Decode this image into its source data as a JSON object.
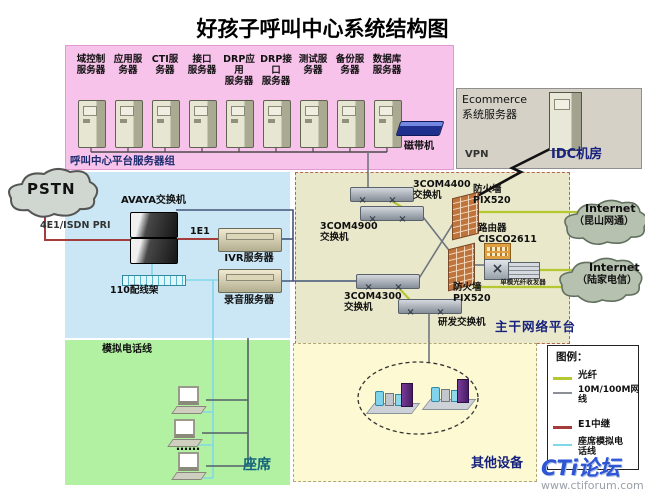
{
  "title": "好孩子呼叫中心系统结构图",
  "server_group": {
    "label": "呼叫中心平台服务器组",
    "servers": [
      "域控制\n服务器",
      "应用服\n务器",
      "CTI服\n务器",
      "接口\n服务器",
      "DRP应用\n服务器",
      "DRP接口\n服务器",
      "测试服\n务器",
      "备份服\n务器",
      "数据库\n服务器"
    ],
    "tape_drive": "磁带机"
  },
  "idc": {
    "label": "IDC机房",
    "vpn": "VPN",
    "server": "Ecommerce\n系统服务器"
  },
  "pstn": {
    "label": "PSTN",
    "trunk": "4E1/ISDN PRI"
  },
  "call_center": {
    "avaya": "AVAYA交换机",
    "e1": "1E1",
    "ivr": "IVR服务器",
    "recorder": "录音服务器",
    "patch_panel": "110配线架"
  },
  "agents": {
    "label": "座席",
    "analog_line": "模拟电话线",
    "dots": "……"
  },
  "backbone": {
    "label": "主干网络平台",
    "sw4400": "3COM4400\n交换机",
    "sw4900": "3COM4900\n交换机",
    "sw4300": "3COM4300\n交换机",
    "rd_switch": "研发交换机",
    "firewall_top": "防火墙\nPIX520",
    "firewall_bottom": "防火墙\nPIX520",
    "router": "路由器\nCISCO2611",
    "transceiver": "单模光纤收发器"
  },
  "others": {
    "label": "其他设备"
  },
  "internet_north": {
    "name": "Internet",
    "provider": "（昆山网通）"
  },
  "internet_south": {
    "name": "Internet",
    "provider": "（陆家电信）"
  },
  "legend": {
    "title": "图例：",
    "items": [
      {
        "label": "光纤",
        "color": "#b5c832"
      },
      {
        "label": "10M/100M网\n线",
        "color": "#8a9096"
      },
      {
        "label": "E1中继",
        "color": "#a43c3c"
      },
      {
        "label": "座席模拟电\n话线",
        "color": "#7fd8e8"
      }
    ]
  },
  "watermark": {
    "logo": "CTi论坛",
    "url": "www.ctiforum.com"
  },
  "colors": {
    "server_group_bg": "#f8c3eb",
    "call_center_bg": "#cbe7f5",
    "agents_bg": "#b2f0a2",
    "backbone_bg": "#eae8ca",
    "others_bg": "#fcf9d3",
    "idc_bg": "#d5d1c7",
    "fiber": "#b5c832",
    "network": "#8a9096",
    "e1_trunk": "#a43c3c",
    "analog": "#7fd8e8"
  }
}
